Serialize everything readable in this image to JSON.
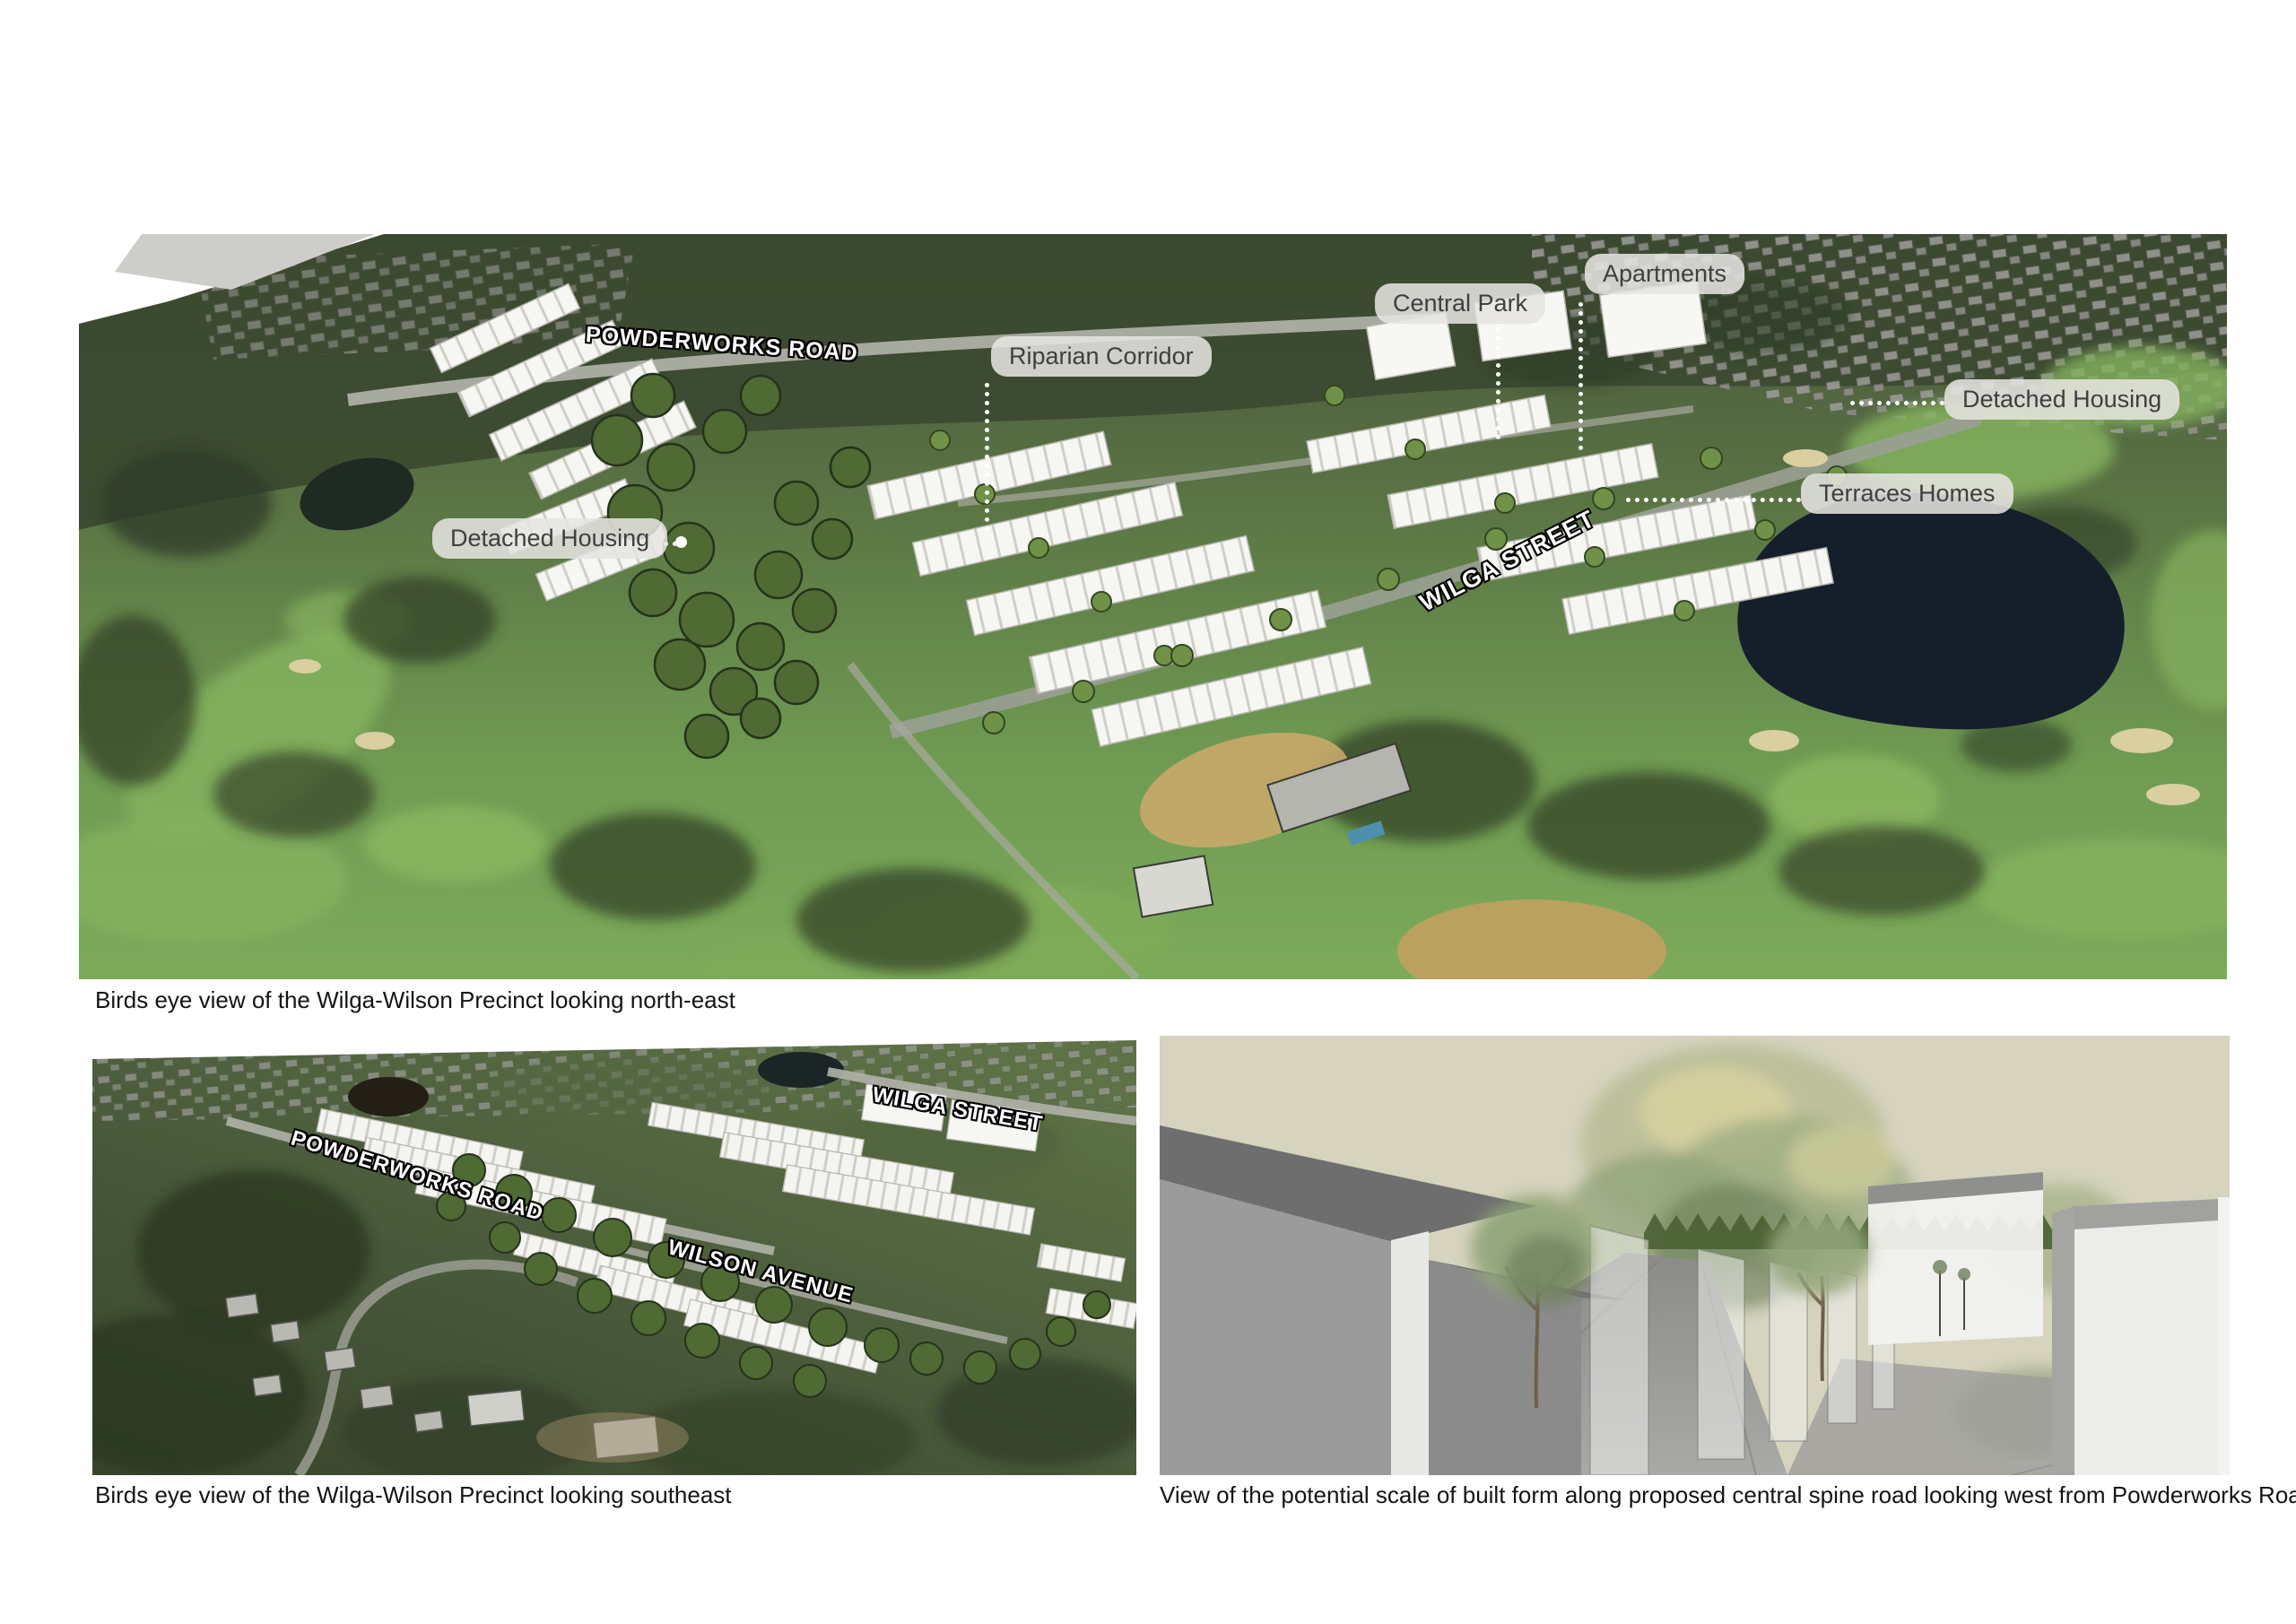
{
  "page": {
    "background": "#ffffff"
  },
  "figure_top": {
    "caption": "Birds eye view of the Wilga-Wilson Precinct looking north-east",
    "roads": {
      "powderworks": "POWDERWORKS ROAD",
      "wilga": "WILGA STREET"
    },
    "callouts": {
      "central_park": "Central Park",
      "apartments": "Apartments",
      "riparian_corridor": "Riparian Corridor",
      "detached_housing_right": "Detached Housing",
      "terraces_homes": "Terraces Homes",
      "detached_housing_left": "Detached Housing"
    }
  },
  "figure_bottom_left": {
    "caption": "Birds eye view of the Wilga-Wilson Precinct looking southeast",
    "roads": {
      "wilga": "WILGA STREET",
      "powderworks": "POWDERWORKS ROAD",
      "wilson": "WILSON AVENUE"
    }
  },
  "figure_bottom_right": {
    "caption": "View of the potential scale of built form along proposed central spine road looking west from Powderworks Road"
  },
  "colors": {
    "golf_green": "#7cab5a",
    "bushland_dark": "#3b4930",
    "cartoon_tree_green": "#4f6a33",
    "pond_dark": "#141f2b",
    "label_pill_bg": "#e6e5e1",
    "label_text": "#3f3f3f",
    "road_label_text": "#ffffff",
    "render_sky": "#d6d3be",
    "render_gray": "#9b9b9b",
    "caption_text": "#141414"
  }
}
